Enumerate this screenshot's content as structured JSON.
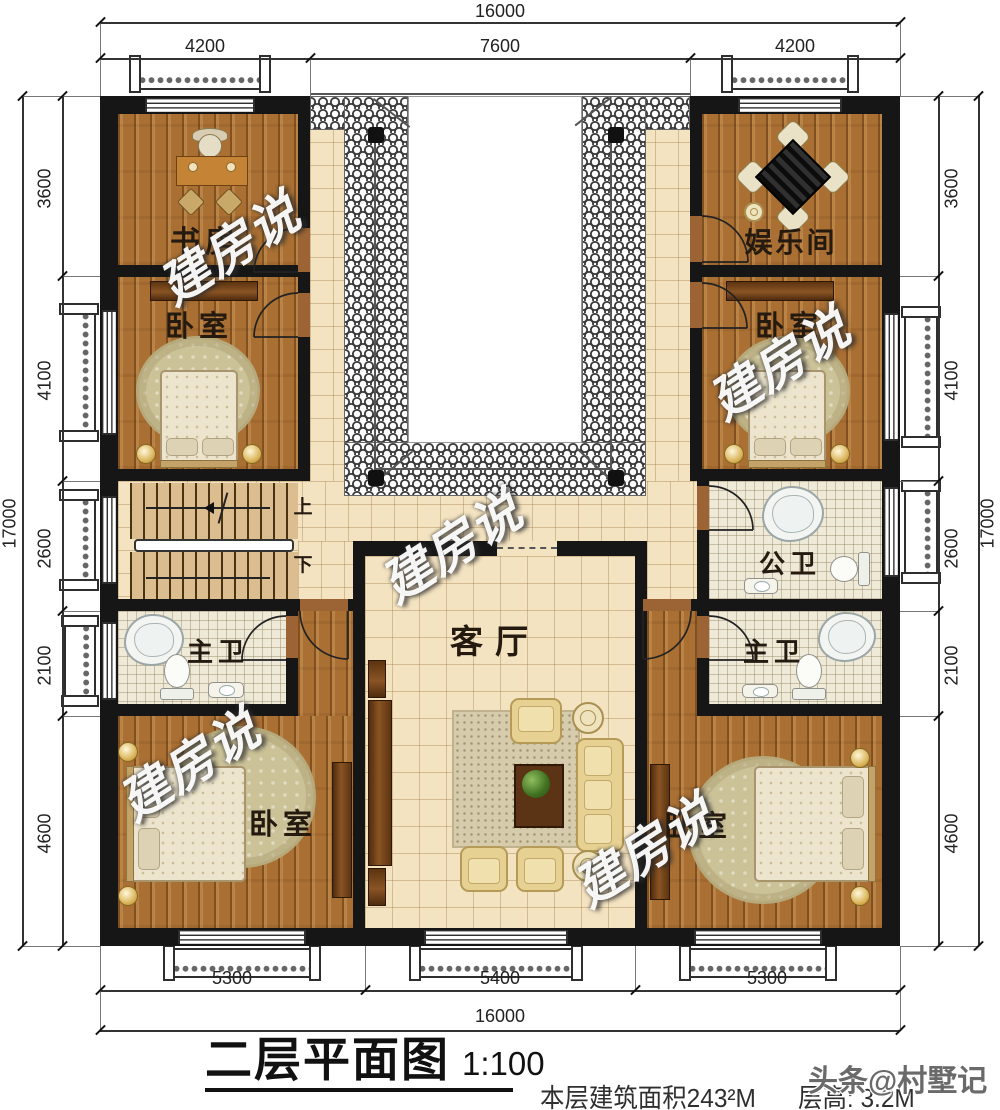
{
  "title": {
    "main": "二层平面图",
    "scale": "1:100"
  },
  "footer": {
    "area": "本层建筑面积243²M",
    "floor_height": "层高: 3.2M"
  },
  "credit": "头条@村墅记",
  "watermark": "建房说",
  "rooms": {
    "study": "书房",
    "entertainment": "娱乐间",
    "bedroom_top_left": "卧室",
    "bedroom_top_right": "卧室",
    "living": "客厅",
    "public_bath": "公卫",
    "master_bath_left": "主卫",
    "master_bath_right": "主卫",
    "bedroom_bottom_left": "卧室",
    "bedroom_bottom_right": "卧室"
  },
  "stairs": {
    "up": "上",
    "down": "下"
  },
  "dimensions": {
    "top": {
      "overall": "16000",
      "segments": [
        "4200",
        "7600",
        "4200"
      ]
    },
    "bottom": {
      "overall": "16000",
      "segments": [
        "5300",
        "5400",
        "5300"
      ]
    },
    "left": {
      "overall": "17000",
      "segments": [
        "3600",
        "4100",
        "2600",
        "2100",
        "4600"
      ]
    },
    "right": {
      "overall": "17000",
      "segments": [
        "3600",
        "4100",
        "2600",
        "2100",
        "4600"
      ]
    }
  },
  "colors": {
    "wall": "#161616",
    "wood_floor": "#a96f33",
    "tile_floor": "#f4e3c1",
    "bath_tile": "#efe9d8",
    "roof_tile_line": "#3a3a3a",
    "dimension_text": "#222222",
    "watermark": "#ffffff"
  }
}
